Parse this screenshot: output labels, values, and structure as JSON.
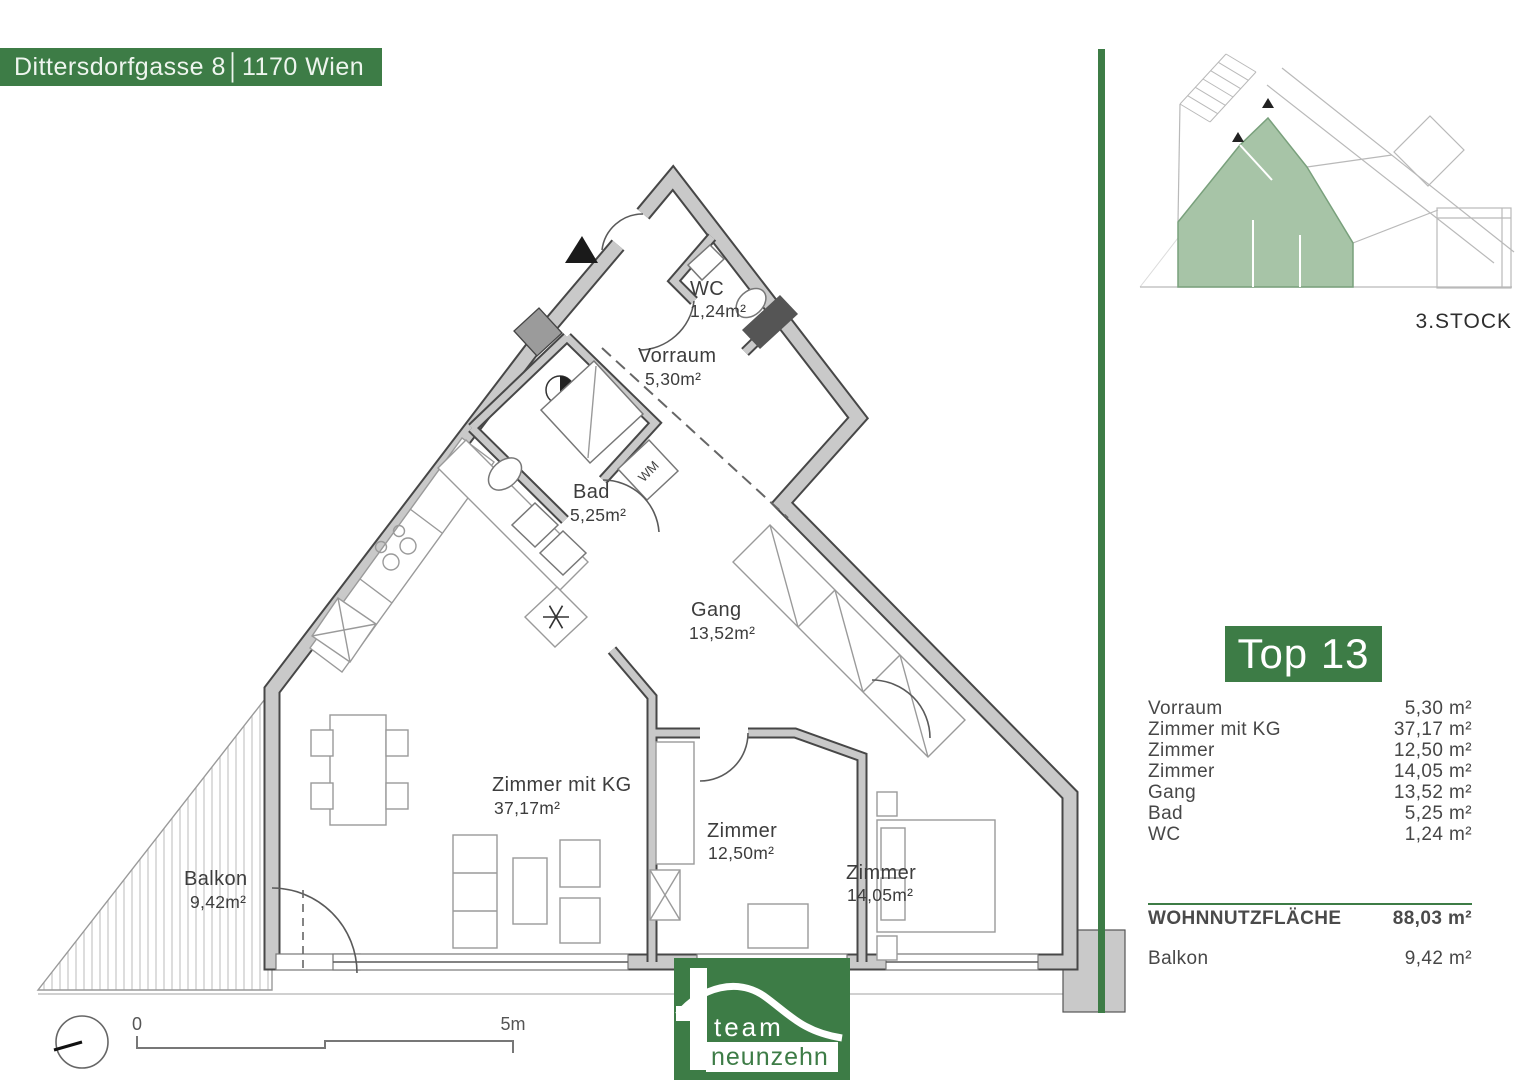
{
  "header": {
    "address": "Dittersdorfgasse 8│1170 Wien"
  },
  "overview": {
    "floor_label": "3.STOCK"
  },
  "unit_panel": {
    "title": "Top 13",
    "rooms": [
      {
        "name": "Vorraum",
        "area": "5,30 m²"
      },
      {
        "name": "Zimmer mit KG",
        "area": "37,17 m²"
      },
      {
        "name": "Zimmer",
        "area": "12,50 m²"
      },
      {
        "name": "Zimmer",
        "area": "14,05 m²"
      },
      {
        "name": "Gang",
        "area": "13,52 m²"
      },
      {
        "name": "Bad",
        "area": "5,25 m²"
      },
      {
        "name": "WC",
        "area": "1,24 m²"
      }
    ],
    "total": {
      "label": "WOHNNUTZFLÄCHE",
      "area": "88,03 m²"
    },
    "balcony": {
      "label": "Balkon",
      "area": "9,42 m²"
    }
  },
  "floorplan": {
    "rooms": [
      {
        "name": "WC",
        "area": "1,24m²"
      },
      {
        "name": "Vorraum",
        "area": "5,30m²"
      },
      {
        "name": "Bad",
        "area": "5,25m²"
      },
      {
        "name": "Gang",
        "area": "13,52m²"
      },
      {
        "name": "Zimmer mit KG",
        "area": "37,17m²"
      },
      {
        "name": "Zimmer",
        "area": "12,50m²"
      },
      {
        "name": "Zimmer",
        "area": "14,05m²"
      },
      {
        "name": "Balkon",
        "area": "9,42m²"
      }
    ],
    "appliance_labels": {
      "washing_machine": "WM"
    },
    "scale": {
      "start": "0",
      "end": "5m"
    }
  },
  "logo": {
    "line1": "team",
    "line2": "neunzehn"
  },
  "colors": {
    "brand_green": "#3d7c46",
    "highlight_green": "#a7c4a7",
    "wall_gray": "#c9c9c9"
  }
}
